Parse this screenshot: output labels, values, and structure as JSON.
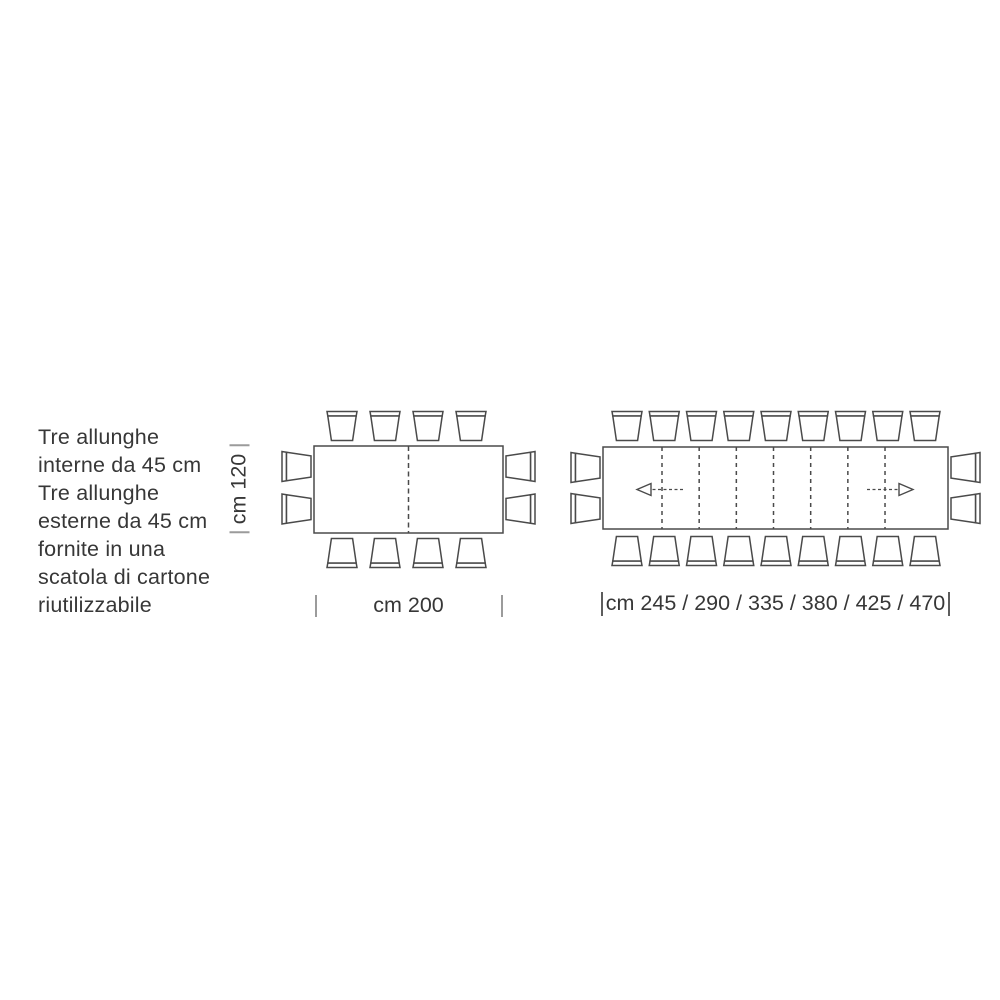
{
  "note": {
    "lines": [
      "Tre allunghe",
      "interne da 45 cm",
      "Tre allunghe",
      "esterne da 45 cm",
      "fornite in una",
      "scatola di cartone",
      "riutilizzabile"
    ]
  },
  "diagram_closed": {
    "width_label": "cm 200",
    "depth_label": "cm 120",
    "chairs": {
      "top": 4,
      "bottom": 4,
      "left": 2,
      "right": 2
    }
  },
  "diagram_extended": {
    "width_label": "cm 245 / 290 / 335 / 380 / 425 / 470",
    "chairs": {
      "top": 9,
      "bottom": 9,
      "left": 2,
      "right": 2
    },
    "leaf_line_count": 7,
    "arrows": [
      "extend-left",
      "extend-right"
    ]
  },
  "colors": {
    "line": "#4a4a4a",
    "text": "#373737",
    "tick": "#9b9b9b",
    "background": "#ffffff"
  }
}
